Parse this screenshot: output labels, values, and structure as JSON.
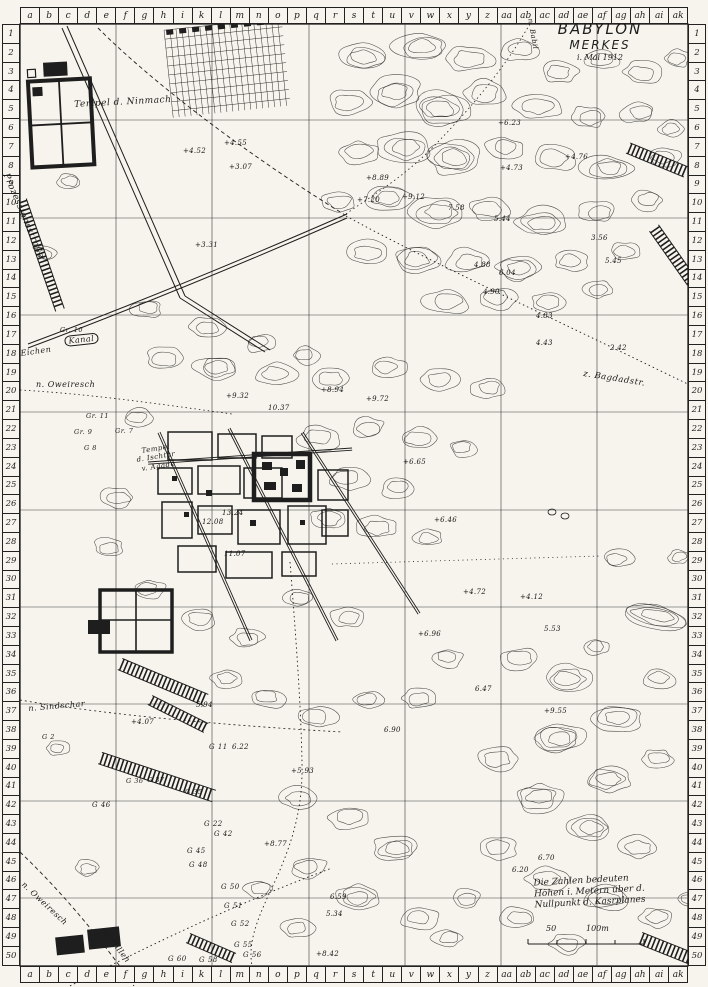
{
  "sheet": {
    "paper_color": "#f6f4ec",
    "ink_color": "#1e1e1e"
  },
  "title": {
    "line1": "BABYLON",
    "line2": "MERKES",
    "line3": "i. Mai 1912"
  },
  "grid": {
    "column_letters": [
      "a",
      "b",
      "c",
      "d",
      "e",
      "f",
      "g",
      "h",
      "i",
      "k",
      "l",
      "m",
      "n",
      "o",
      "p",
      "q",
      "r",
      "s",
      "t",
      "u",
      "v",
      "w",
      "x",
      "y",
      "z",
      "aa",
      "ab",
      "ac",
      "ad",
      "ae",
      "af",
      "ag",
      "ah",
      "ai",
      "ak"
    ],
    "row_numbers": [
      "1",
      "2",
      "3",
      "4",
      "5",
      "6",
      "7",
      "8",
      "9",
      "10",
      "11",
      "12",
      "13",
      "14",
      "15",
      "16",
      "17",
      "18",
      "19",
      "20",
      "21",
      "22",
      "23",
      "24",
      "25",
      "26",
      "27",
      "28",
      "29",
      "30",
      "31",
      "32",
      "33",
      "34",
      "35",
      "36",
      "37",
      "38",
      "39",
      "40",
      "41",
      "42",
      "43",
      "44",
      "45",
      "46",
      "47",
      "48",
      "49",
      "50"
    ]
  },
  "legend": {
    "note_lines": [
      "Die Zahlen bedeuten",
      "Höhen i. Metern über d.",
      "Nullpunkt d. Kasrplanes"
    ],
    "scale_left": "50",
    "scale_right": "100m"
  },
  "map_labels": [
    {
      "text": "Tempel d. Ninmach",
      "x": 74,
      "y": 100,
      "rot": -3,
      "size": 9
    },
    {
      "text": "Prozessionsstraße",
      "x": 10,
      "y": 172,
      "rot": 67,
      "size": 9
    },
    {
      "text": "Gr. 10",
      "x": 60,
      "y": 326,
      "size": 6.5
    },
    {
      "text": "Kanal",
      "x": 64,
      "y": 336,
      "rot": -6,
      "size": 8,
      "boxed": true
    },
    {
      "text": "Eichen",
      "x": 20,
      "y": 349,
      "rot": -8,
      "size": 8
    },
    {
      "text": "n. Oweiresch",
      "x": 36,
      "y": 380,
      "size": 8
    },
    {
      "text": "z. Bagdadstr.",
      "x": 584,
      "y": 369,
      "rot": 9,
      "size": 8.5
    },
    {
      "text": "Tempel",
      "x": 141,
      "y": 447,
      "rot": -9,
      "size": 7
    },
    {
      "text": "d. Ischtar",
      "x": 136,
      "y": 456,
      "rot": -9,
      "size": 7
    },
    {
      "text": "v. Agade",
      "x": 141,
      "y": 465,
      "rot": -9,
      "size": 7
    },
    {
      "text": "Gr. 11",
      "x": 86,
      "y": 412,
      "size": 6.5
    },
    {
      "text": "Gr. 9",
      "x": 74,
      "y": 428,
      "size": 6.5
    },
    {
      "text": "Gr. 7",
      "x": 115,
      "y": 427,
      "size": 6.5
    },
    {
      "text": "G 8",
      "x": 84,
      "y": 444,
      "size": 6.5
    },
    {
      "text": "n. Sindschar",
      "x": 28,
      "y": 704,
      "rot": -5,
      "size": 8
    },
    {
      "text": "n. Hilleh",
      "x": 108,
      "y": 928,
      "rot": 52,
      "size": 8
    },
    {
      "text": "n. Oweiresch",
      "x": 26,
      "y": 880,
      "rot": 43,
      "size": 8
    },
    {
      "text": "n. Babil",
      "x": 534,
      "y": 18,
      "rot": 80,
      "size": 7
    },
    {
      "text": "G 2",
      "x": 42,
      "y": 733,
      "size": 6.5
    },
    {
      "text": "G 11",
      "x": 209,
      "y": 743,
      "size": 7
    },
    {
      "text": "G 46",
      "x": 92,
      "y": 801,
      "size": 7
    },
    {
      "text": "G 36",
      "x": 126,
      "y": 777,
      "size": 6.5
    },
    {
      "text": "G 37",
      "x": 147,
      "y": 776,
      "size": 6.5
    },
    {
      "text": "G 35",
      "x": 185,
      "y": 788,
      "size": 6.5
    },
    {
      "text": "G 22",
      "x": 204,
      "y": 820,
      "size": 7
    },
    {
      "text": "G 42",
      "x": 214,
      "y": 830,
      "size": 7
    },
    {
      "text": "G 45",
      "x": 187,
      "y": 847,
      "size": 7
    },
    {
      "text": "G 48",
      "x": 189,
      "y": 861,
      "size": 7
    },
    {
      "text": "G 50",
      "x": 221,
      "y": 883,
      "size": 7
    },
    {
      "text": "G 51",
      "x": 224,
      "y": 902,
      "size": 7
    },
    {
      "text": "G 52",
      "x": 231,
      "y": 920,
      "size": 7
    },
    {
      "text": "G 55",
      "x": 234,
      "y": 941,
      "size": 7
    },
    {
      "text": "G 60",
      "x": 168,
      "y": 955,
      "size": 7
    },
    {
      "text": "G 58",
      "x": 199,
      "y": 956,
      "size": 7
    },
    {
      "text": "G 56",
      "x": 243,
      "y": 951,
      "size": 7
    }
  ],
  "spot_heights": [
    {
      "v": "+4.52",
      "x": 183,
      "y": 147
    },
    {
      "v": "+4.55",
      "x": 224,
      "y": 139
    },
    {
      "v": "+3.07",
      "x": 229,
      "y": 163
    },
    {
      "v": "+3.31",
      "x": 195,
      "y": 241
    },
    {
      "v": "+6.23",
      "x": 498,
      "y": 119
    },
    {
      "v": "+4.76",
      "x": 565,
      "y": 153
    },
    {
      "v": "+4.73",
      "x": 500,
      "y": 164
    },
    {
      "v": "+8.89",
      "x": 366,
      "y": 174
    },
    {
      "v": "+7.20",
      "x": 357,
      "y": 196
    },
    {
      "v": "+9.12",
      "x": 402,
      "y": 193
    },
    {
      "v": "7.58",
      "x": 448,
      "y": 204
    },
    {
      "v": "5.44",
      "x": 494,
      "y": 215
    },
    {
      "v": "4.88",
      "x": 474,
      "y": 261
    },
    {
      "v": "6.04",
      "x": 499,
      "y": 269
    },
    {
      "v": "4.90",
      "x": 483,
      "y": 288
    },
    {
      "v": "4.83",
      "x": 536,
      "y": 312
    },
    {
      "v": "3.56",
      "x": 591,
      "y": 234
    },
    {
      "v": "5.45",
      "x": 605,
      "y": 257
    },
    {
      "v": "4.43",
      "x": 536,
      "y": 339
    },
    {
      "v": "2.42",
      "x": 610,
      "y": 344
    },
    {
      "v": "+9.32",
      "x": 226,
      "y": 392
    },
    {
      "v": "10.37",
      "x": 268,
      "y": 404
    },
    {
      "v": "+8.94",
      "x": 321,
      "y": 386
    },
    {
      "v": "+9.72",
      "x": 366,
      "y": 395
    },
    {
      "v": "+6.65",
      "x": 403,
      "y": 458
    },
    {
      "v": "+6.46",
      "x": 434,
      "y": 516
    },
    {
      "v": "13.24",
      "x": 222,
      "y": 509
    },
    {
      "v": "12.08",
      "x": 202,
      "y": 518
    },
    {
      "v": "11.07",
      "x": 224,
      "y": 550
    },
    {
      "v": "+4.72",
      "x": 463,
      "y": 588
    },
    {
      "v": "+4.12",
      "x": 520,
      "y": 593
    },
    {
      "v": "5.53",
      "x": 544,
      "y": 625
    },
    {
      "v": "+6.96",
      "x": 418,
      "y": 630
    },
    {
      "v": "6.47",
      "x": 475,
      "y": 685
    },
    {
      "v": "+9.55",
      "x": 544,
      "y": 707
    },
    {
      "v": "6.90",
      "x": 384,
      "y": 726
    },
    {
      "v": "5.94",
      "x": 196,
      "y": 701
    },
    {
      "v": "6.22",
      "x": 232,
      "y": 743
    },
    {
      "v": "+4.07",
      "x": 131,
      "y": 718
    },
    {
      "v": "+5.93",
      "x": 291,
      "y": 767
    },
    {
      "v": "+8.77",
      "x": 264,
      "y": 840
    },
    {
      "v": "6.59",
      "x": 330,
      "y": 893
    },
    {
      "v": "5.34",
      "x": 326,
      "y": 910
    },
    {
      "v": "+8.42",
      "x": 316,
      "y": 950
    },
    {
      "v": "6.70",
      "x": 538,
      "y": 854
    },
    {
      "v": "6.20",
      "x": 512,
      "y": 866
    }
  ]
}
